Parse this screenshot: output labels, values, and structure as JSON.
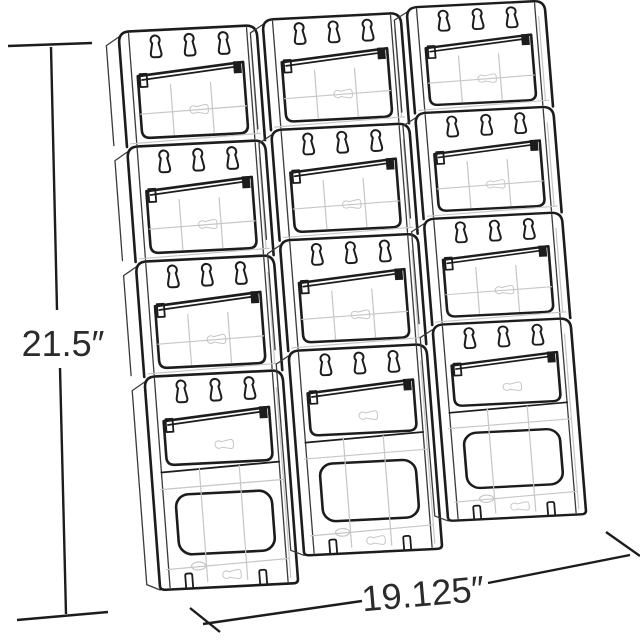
{
  "figure": {
    "type": "technical-line-drawing",
    "subject": "wall-mount literature holder",
    "pocket_rows": 4,
    "pocket_columns": 3,
    "pocket_count": 12,
    "keyhole_slots_per_pocket": 3
  },
  "dimensions": {
    "height_label": "21.5″",
    "width_label": "19.125″"
  },
  "colors": {
    "outline": "#1c1c1c",
    "hidden_line": "#c6c6c6",
    "background": "#ffffff",
    "label_text": "#2b2b2b"
  }
}
